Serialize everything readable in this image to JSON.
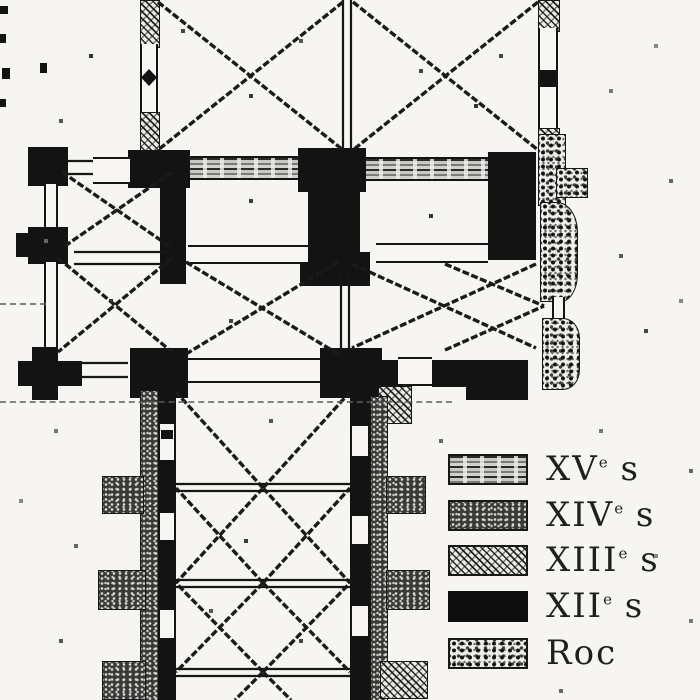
{
  "document": {
    "type": "scanned-architectural-floor-plan",
    "subject": "cruciform church ground plan with construction-phase legend"
  },
  "legend": {
    "entries": [
      {
        "id": "xv",
        "roman": "XV",
        "sup": "e",
        "suffix": " s",
        "label": "XVe s",
        "pattern": "horizontal-streak-hatch"
      },
      {
        "id": "xiv",
        "roman": "XIV",
        "sup": "e",
        "suffix": " s",
        "label": "XIVe s",
        "pattern": "fine-stipple"
      },
      {
        "id": "xiii",
        "roman": "XIII",
        "sup": "e",
        "suffix": " s",
        "label": "XIIIe s",
        "pattern": "diagonal-scribble-hatch"
      },
      {
        "id": "xii",
        "roman": "XII",
        "sup": "e",
        "suffix": " s",
        "label": "XIIe s",
        "pattern": "solid-black"
      },
      {
        "id": "roc",
        "roman": "Roc",
        "sup": "",
        "suffix": "",
        "label": "Roc",
        "pattern": "coarse-stipple"
      }
    ]
  },
  "plan": {
    "parts": [
      "choir",
      "transept",
      "crossing-piers",
      "nave",
      "side-buttresses",
      "east-rock-apse"
    ]
  },
  "colors": {
    "paper": "#f6f5f1",
    "ink": "#131313",
    "hatch_gray": "#8a8a86",
    "stipple_dark": "#3a3a37"
  }
}
